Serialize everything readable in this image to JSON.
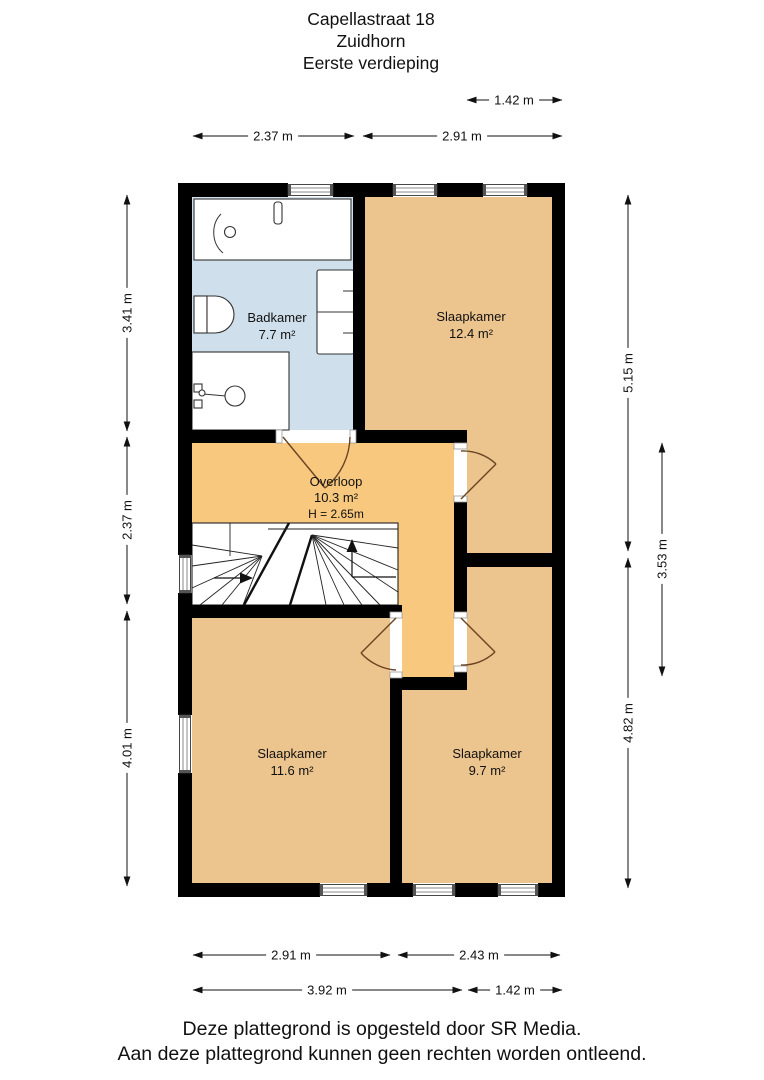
{
  "title": {
    "address": "Capellastraat 18",
    "city": "Zuidhorn",
    "floor": "Eerste verdieping"
  },
  "rooms": {
    "badkamer": {
      "name": "Badkamer",
      "area": "7.7 m²"
    },
    "slaapkamer_groot": {
      "name": "Slaapkamer",
      "area": "12.4 m²"
    },
    "overloop": {
      "name": "Overloop",
      "area": "10.3 m²",
      "ceiling_height": "H = 2.65m"
    },
    "slaapkamer_links": {
      "name": "Slaapkamer",
      "area": "11.6 m²"
    },
    "slaapkamer_rechts": {
      "name": "Slaapkamer",
      "area": "9.7 m²"
    }
  },
  "dimensions": {
    "top_offset": "1.42 m",
    "top_left": "2.37 m",
    "top_right": "2.91 m",
    "left_upper": "3.41 m",
    "left_middle": "2.37 m",
    "left_lower": "4.01 m",
    "right_upper": "5.15 m",
    "right_inner": "3.53 m",
    "right_lower": "4.82 m",
    "bottom_left": "2.91 m",
    "bottom_right": "2.43 m",
    "bottom_total_left": "3.92 m",
    "bottom_offset": "1.42 m"
  },
  "footer": {
    "line1": "Deze plattegrond is opgesteld door SR Media.",
    "line2": "Aan deze plattegrond kunnen geen rechten worden ontleend."
  },
  "colors": {
    "wall": "#000000",
    "bedroom_fill": "#ecc48e",
    "hall_fill": "#f8c87e",
    "bathroom_fill": "#cfdfeb",
    "door": "#6a4423"
  }
}
